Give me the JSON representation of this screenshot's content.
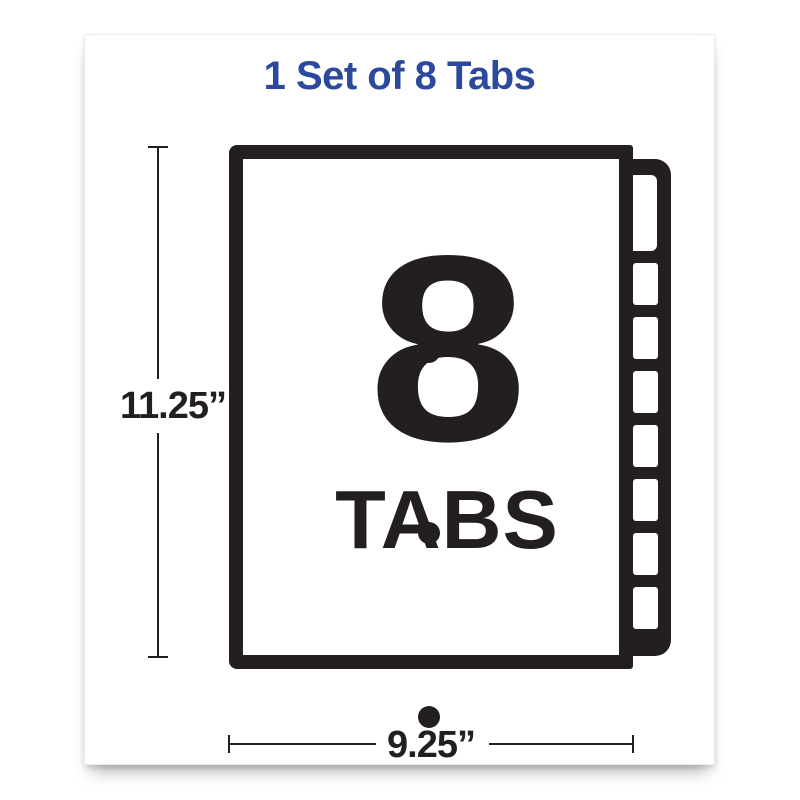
{
  "header": {
    "title": "1 Set of 8 Tabs"
  },
  "colors": {
    "accent_blue": "#2b4a9e",
    "ink_black": "#231f20",
    "paper_white": "#ffffff"
  },
  "diagram": {
    "numeral": "8",
    "numeral_label": "TABS",
    "height_dimension": "11.25”",
    "width_dimension": "9.25”",
    "tab_count": 8,
    "small_tab_slots": 7,
    "punch_holes": 3
  }
}
